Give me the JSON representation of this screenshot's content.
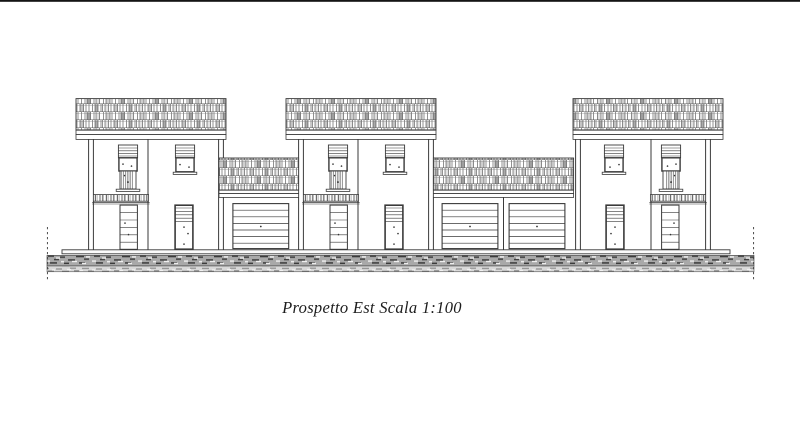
{
  "page": {
    "background_color": "#ffffff",
    "line_color": "#3a3a3a",
    "top_border_color": "#141414"
  },
  "caption": {
    "text": "Prospetto Est Scala 1:100",
    "view_name": "Prospetto Est",
    "scale": "Scala 1:100"
  },
  "drawing": {
    "kind": "architectural elevation",
    "house_count": 3,
    "garage_door_count": 3,
    "visible_elements": [
      "tiled-roof-band",
      "shuttered-window",
      "plain-window",
      "striped-entry-door",
      "paneled-entry-door",
      "garage-door",
      "entrance-canopy",
      "sidewalk-slab",
      "gravel-ground-band",
      "boundary-dashed-lines"
    ]
  }
}
